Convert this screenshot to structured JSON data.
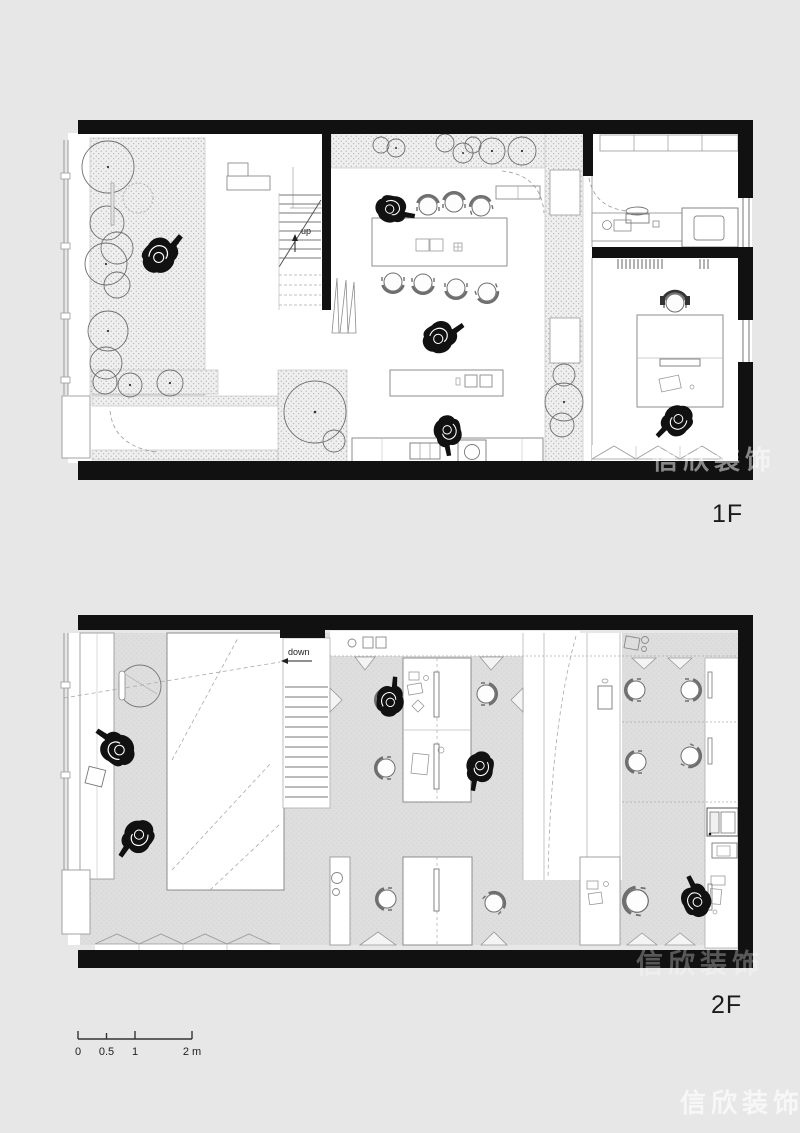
{
  "floors": [
    {
      "label": "1F",
      "stair_label": "up"
    },
    {
      "label": "2F",
      "stair_label": "down"
    }
  ],
  "scale_bar": {
    "ticks": [
      "0",
      "0.5",
      "1",
      "2 m"
    ]
  },
  "watermark": {
    "text": "信欣装饰"
  },
  "colors": {
    "background": "#e7e7e7",
    "wall": "#111111",
    "paper": "#ffffff",
    "floor_hatch": "#dedede",
    "planting_dots": "#9c9c9c",
    "line": "#8c8c8c"
  }
}
